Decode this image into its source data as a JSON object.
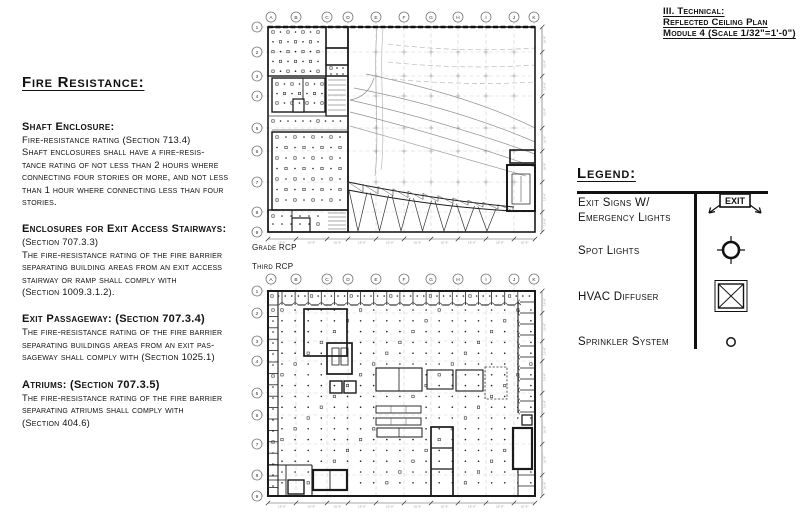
{
  "title_block": {
    "lines": [
      "III. Technical:",
      "Reflected Ceiling Plan",
      "Module 4 (Scale 1/32\"=1'-0\")"
    ]
  },
  "fire_resistance": {
    "heading": "Fire Resistance:",
    "sections": [
      {
        "heading": "Shaft Enclosure:",
        "body": "Fire-resistance rating (Section 713.4)\nShaft enclosures shall have a fire-resis-\ntance rating of not less than 2 hours where\nconnecting four stories or more, and not less\nthan 1 hour where connecting less than four\nstories."
      },
      {
        "heading": "Enclosures for Exit Access Stairways:",
        "body": "(Section 707.3.3)\nThe fire-resistance rating of the fire barrier\nseparating building areas from an exit access\nstairway or ramp shall comply with\n(Section 1009.3.1.2)."
      },
      {
        "heading": "Exit Passageway: (Section 707.3.4)",
        "body": "The fire-resistance rating of the fire barrier\nseparating buildings areas from an exit pas-\nsageway shall comply with (Section 1025.1)"
      },
      {
        "heading": "Atriums: (Section 707.3.5)",
        "body": "The fire-resistance rating of the fire barrier\nseparating atriums shall comply with\n(Section 404.6)"
      }
    ]
  },
  "legend": {
    "heading": "Legend:",
    "exit_icon_text": "EXIT",
    "items": [
      {
        "label": "Exit Signs W/\nEmergency Lights",
        "icon": "exit-sign-icon"
      },
      {
        "label": "Spot Lights",
        "icon": "spot-light-icon"
      },
      {
        "label": "HVAC Diffuser",
        "icon": "hvac-diffuser-icon"
      },
      {
        "label": "Sprinkler System",
        "icon": "sprinkler-icon"
      }
    ]
  },
  "plans": [
    {
      "label": "Grade RCP",
      "columns": [
        "A",
        "B",
        "C",
        "D",
        "E",
        "F",
        "G",
        "H",
        "I",
        "J",
        "K"
      ],
      "rows": [
        "1",
        "2",
        "3",
        "4",
        "5",
        "6",
        "7",
        "8",
        "9"
      ],
      "dim_label": "16'-8\""
    },
    {
      "label": "Third RCP",
      "columns": [
        "A",
        "B",
        "C",
        "D",
        "E",
        "F",
        "G",
        "H",
        "I",
        "J",
        "K"
      ],
      "rows": [
        "1",
        "2",
        "3",
        "4",
        "5",
        "6",
        "7",
        "8",
        "9"
      ],
      "dim_label": "16'-8\""
    }
  ],
  "colors": {
    "ink": "#111111",
    "faint": "#999999",
    "paper": "#ffffff"
  }
}
